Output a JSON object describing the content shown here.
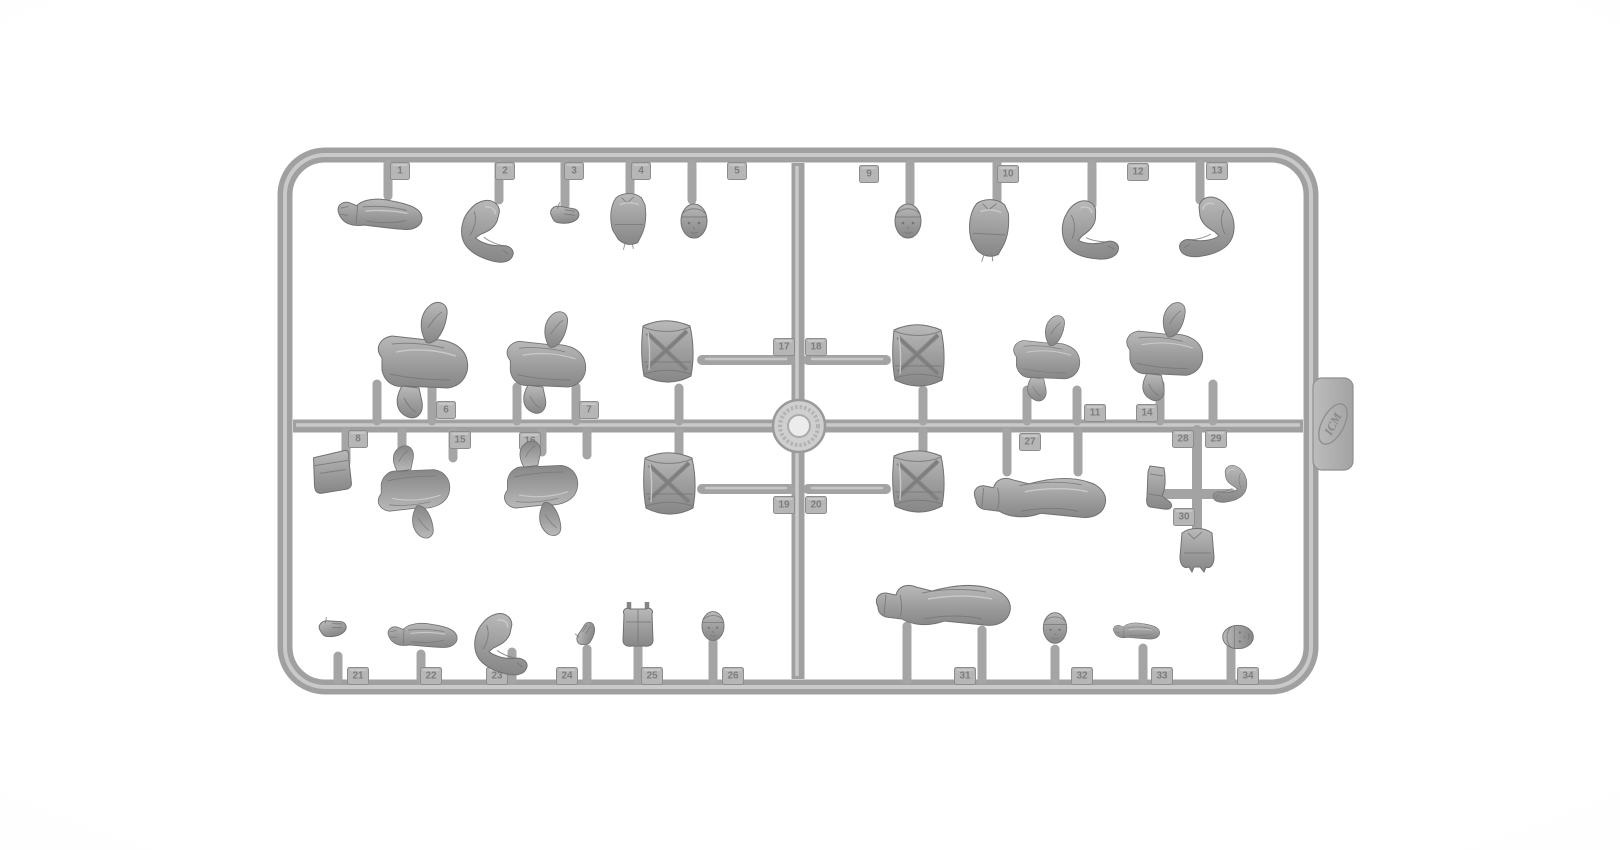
{
  "scene": {
    "subject": "Photograph of a gray injection-molded plastic sprue (parts frame) holding unassembled model figure parts",
    "brand": "ICM",
    "background_color": "#ffffff",
    "sprue_color": "#a0a0a0",
    "sprue_highlight": "#c9c9c9",
    "part_color": "#9a9a9a",
    "part_shadow": "#717171"
  },
  "tags": {
    "p1": "1",
    "p2": "2",
    "p3": "3",
    "p4": "4",
    "p5": "5",
    "p6": "6",
    "p7": "7",
    "p8": "8",
    "p9": "9",
    "p10": "10",
    "p11": "11",
    "p12": "12",
    "p13": "13",
    "p14": "14",
    "p15": "15",
    "p16": "16",
    "p17": "17",
    "p18": "18",
    "p19": "19",
    "p20": "20",
    "p21": "21",
    "p22": "22",
    "p23": "23",
    "p24": "24",
    "p25": "25",
    "p26": "26",
    "p27": "27",
    "p28": "28",
    "p29": "29",
    "p30": "30",
    "p31": "31",
    "p32": "32",
    "p33": "33",
    "p34": "34"
  },
  "parts_catalog": [
    {
      "tag": "1",
      "part": "straight arm with open hand",
      "location": "top-left row, hanging"
    },
    {
      "tag": "2",
      "part": "bent arm",
      "location": "top-left row, hanging"
    },
    {
      "tag": "3",
      "part": "hand",
      "location": "top-left row, hanging"
    },
    {
      "tag": "4",
      "part": "torso with harness",
      "location": "top-left row, hanging"
    },
    {
      "tag": "5",
      "part": "head with cap",
      "location": "top-left row, hanging"
    },
    {
      "tag": "6",
      "part": "bent legs, boot raised",
      "location": "middle-left row, standing on rail"
    },
    {
      "tag": "7",
      "part": "bent legs, boot raised",
      "location": "middle-left row, standing on rail"
    },
    {
      "tag": "8",
      "part": "pouch / bag",
      "location": "below middle rail, left"
    },
    {
      "tag": "9",
      "part": "bare head",
      "location": "top-right row, hanging"
    },
    {
      "tag": "10",
      "part": "torso with straps",
      "location": "top-right row, hanging"
    },
    {
      "tag": "11",
      "part": "bent legs",
      "location": "middle-right row, standing on rail"
    },
    {
      "tag": "12",
      "part": "bent arm with mitt",
      "location": "top-right row, hanging"
    },
    {
      "tag": "13",
      "part": "bent arm with open fingers",
      "location": "top-right row, hanging"
    },
    {
      "tag": "14",
      "part": "bent legs",
      "location": "middle-right row, standing on rail"
    },
    {
      "tag": "15",
      "part": "bent legs, boot down",
      "location": "below middle rail, left"
    },
    {
      "tag": "16",
      "part": "bent legs, boot down",
      "location": "below middle rail, left"
    },
    {
      "tag": "17",
      "part": "drum torso with crossed straps",
      "location": "center cross, upper-left"
    },
    {
      "tag": "18",
      "part": "drum torso with crossed straps",
      "location": "center cross, upper-right"
    },
    {
      "tag": "19",
      "part": "drum torso with crossed straps",
      "location": "center cross, lower-left"
    },
    {
      "tag": "20",
      "part": "drum torso with crossed straps",
      "location": "center cross, lower-right"
    },
    {
      "tag": "21",
      "part": "small hand",
      "location": "bottom-left row, standing on rail"
    },
    {
      "tag": "22",
      "part": "straight arm",
      "location": "bottom-left row, standing on rail"
    },
    {
      "tag": "23",
      "part": "bent arm",
      "location": "bottom-left row, standing on rail"
    },
    {
      "tag": "24",
      "part": "fist",
      "location": "bottom-left row, standing on rail"
    },
    {
      "tag": "25",
      "part": "vest / jacket front",
      "location": "bottom-left row, standing on rail"
    },
    {
      "tag": "26",
      "part": "head",
      "location": "bottom-left row, standing on rail"
    },
    {
      "tag": "27",
      "part": "lying bent legs",
      "location": "below middle rail, right"
    },
    {
      "tag": "28",
      "part": "boot",
      "location": "right sub-frame, hanging"
    },
    {
      "tag": "29",
      "part": "bent arm",
      "location": "right sub-frame, hanging"
    },
    {
      "tag": "30",
      "part": "small jacket",
      "location": "right sub-frame, hanging"
    },
    {
      "tag": "31",
      "part": "lying bent legs",
      "location": "bottom-right row, standing on rail"
    },
    {
      "tag": "32",
      "part": "head",
      "location": "bottom-right row, standing on rail"
    },
    {
      "tag": "33",
      "part": "forearm with fist",
      "location": "bottom-right row, standing on rail"
    },
    {
      "tag": "34",
      "part": "head, lying sideways",
      "location": "bottom-right row, standing on rail"
    }
  ]
}
